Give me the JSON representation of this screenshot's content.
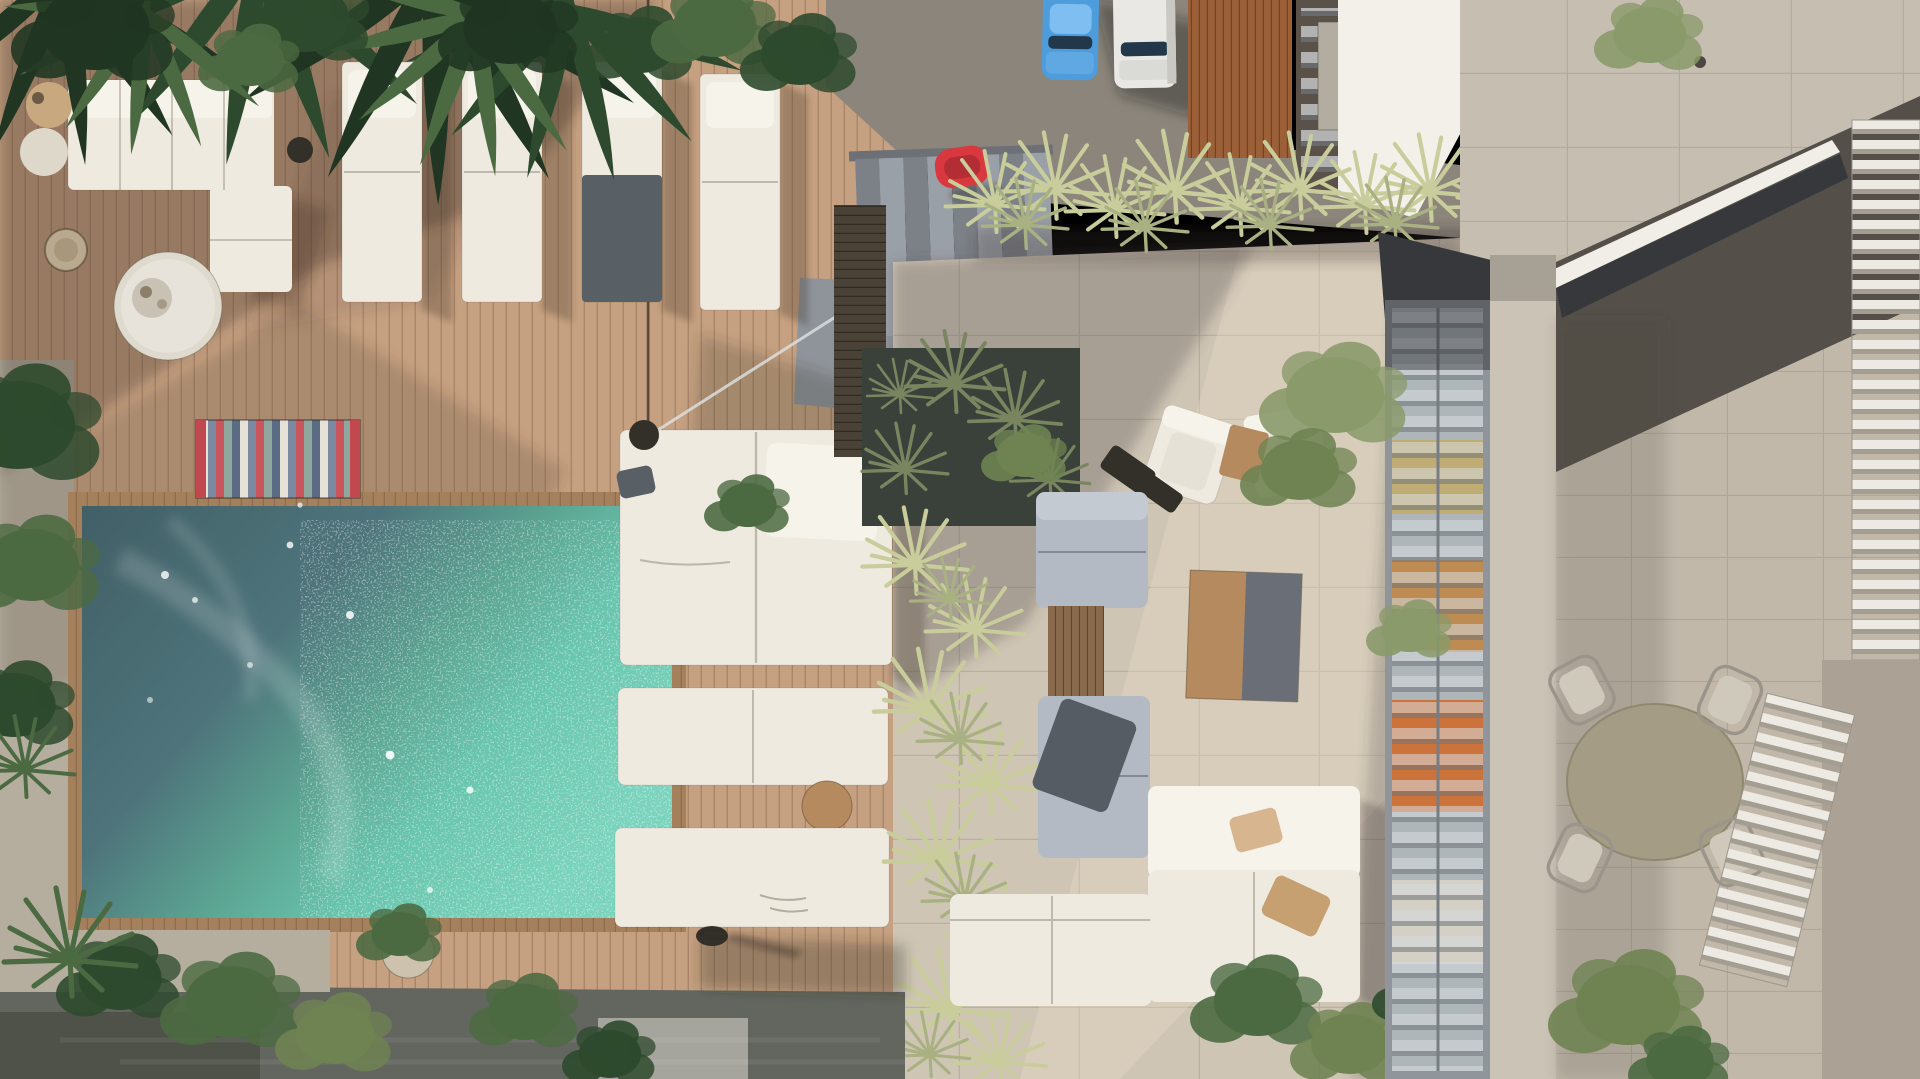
{
  "scene": {
    "type": "architectural-aerial-render",
    "setting": "top-down view of a residential rooftop: wooden deck with turquoise pool and sun loungers (left), stone patio lounge (center), parking street with two cars and stairs (top), concrete building with glazed lightwell and dining terrace (right)",
    "inventory": [
      "swimming-pool",
      "wood-deck",
      "striped-mat",
      "sectional-sofa",
      "sun-loungers",
      "daybeds",
      "grass-hedge",
      "planter",
      "stone-patio",
      "armchairs",
      "coffee-table",
      "gray-lounge",
      "white-l-sofa",
      "stairs",
      "red-chair",
      "blue-car",
      "white-van",
      "skylight-glazing",
      "dining-set",
      "louvre-shutters",
      "palm-foliage"
    ],
    "palette": {
      "deck_light": "#c5a081",
      "trim": "#a5805c",
      "pool_g1": "#415f66",
      "pool_g2": "#4e747b",
      "pool_g3": "#5ba291",
      "pool_g4": "#68c5ad",
      "pool_g5": "#7ad3bc",
      "white_furn": "#efeae0",
      "white_bright": "#f6f3ea",
      "gray_furn": "#b4bac3",
      "dark_cushion": "#586066",
      "throw_dark": "#565c64",
      "dark_obj": "#33302a",
      "table_white": "#dedace",
      "table_wood": "#b58a5e",
      "table_gray": "#6a6f77",
      "table_olive": "#a49c84",
      "pillow_tan": "#c7a072",
      "pillow_tan2": "#d7b68f",
      "red_chair": "#d8383e",
      "car_blue": "#4d9ddc",
      "car_blue_roof": "#7fbef0",
      "car_white": "#e9e8e4",
      "glass_dark": "#22384a",
      "drive": "#8b857b",
      "stairs_light": "#9aa0a7",
      "stairs_dark": "#7c8187",
      "landing": "#8f939a",
      "patio": "#cfc5b5",
      "court_stone": "#c1b8aa",
      "concrete": "#c6beb1",
      "concrete_light": "#cbc3b6",
      "white_wall": "#f3f0e9",
      "wood_slat": "#9b6038",
      "wood_dark": "#4a4236",
      "wood_mid": "#8a6a4c",
      "planter_dark": "#3a403a",
      "glass_cool": "#aeb6ba",
      "louvre_light": "#d6dbde",
      "louvre_dark": "#6e757b",
      "warm1": "#c08648",
      "warm2": "#cf6a2e",
      "warm3": "#c3ac69",
      "shutter_white": "#eceae2",
      "shutter_gray": "#a39d92",
      "wall_right": "#aba295",
      "lower_dark": "#63655f",
      "ledge": "#b5ae9f",
      "light_blob": "#b2b0a8",
      "rattan": "#b9a98e",
      "side_tan": "#c8a87e",
      "side_cream": "#ded8cb",
      "pot": "#cdc2ae",
      "mat_red": "#c0484e",
      "mat_s1": "#e6e2d8",
      "mat_s2": "#7b89a1",
      "mat_s3": "#c8565c",
      "mat_s4": "#8fa79e",
      "mat_s5": "#5c6b84",
      "grass_light": "#c9cc9b",
      "grass_mid": "#a9b183",
      "grass_dark": "#79855f",
      "green_darkest": "#203622",
      "green_dark": "#2e4a2e",
      "green_mid": "#4c6a42",
      "green_leaf": "#6f8352",
      "green_soft": "#8a9a6a",
      "white_rail": "#f1eee8",
      "slot_dark": "#37383c",
      "ceiling_dark": "#544f49",
      "chair_wire": "#9a948a",
      "seat_light": "#cfc9bc",
      "shadow_warm": "rgba(66,50,38,0.35)",
      "shadow_cool": "rgba(80,74,70,0.30)",
      "shadow_soft": "rgba(60,55,50,0.22)",
      "shadow_deep": "rgba(28,28,30,0.38)",
      "sun_glow": "#e7dcc6"
    }
  }
}
